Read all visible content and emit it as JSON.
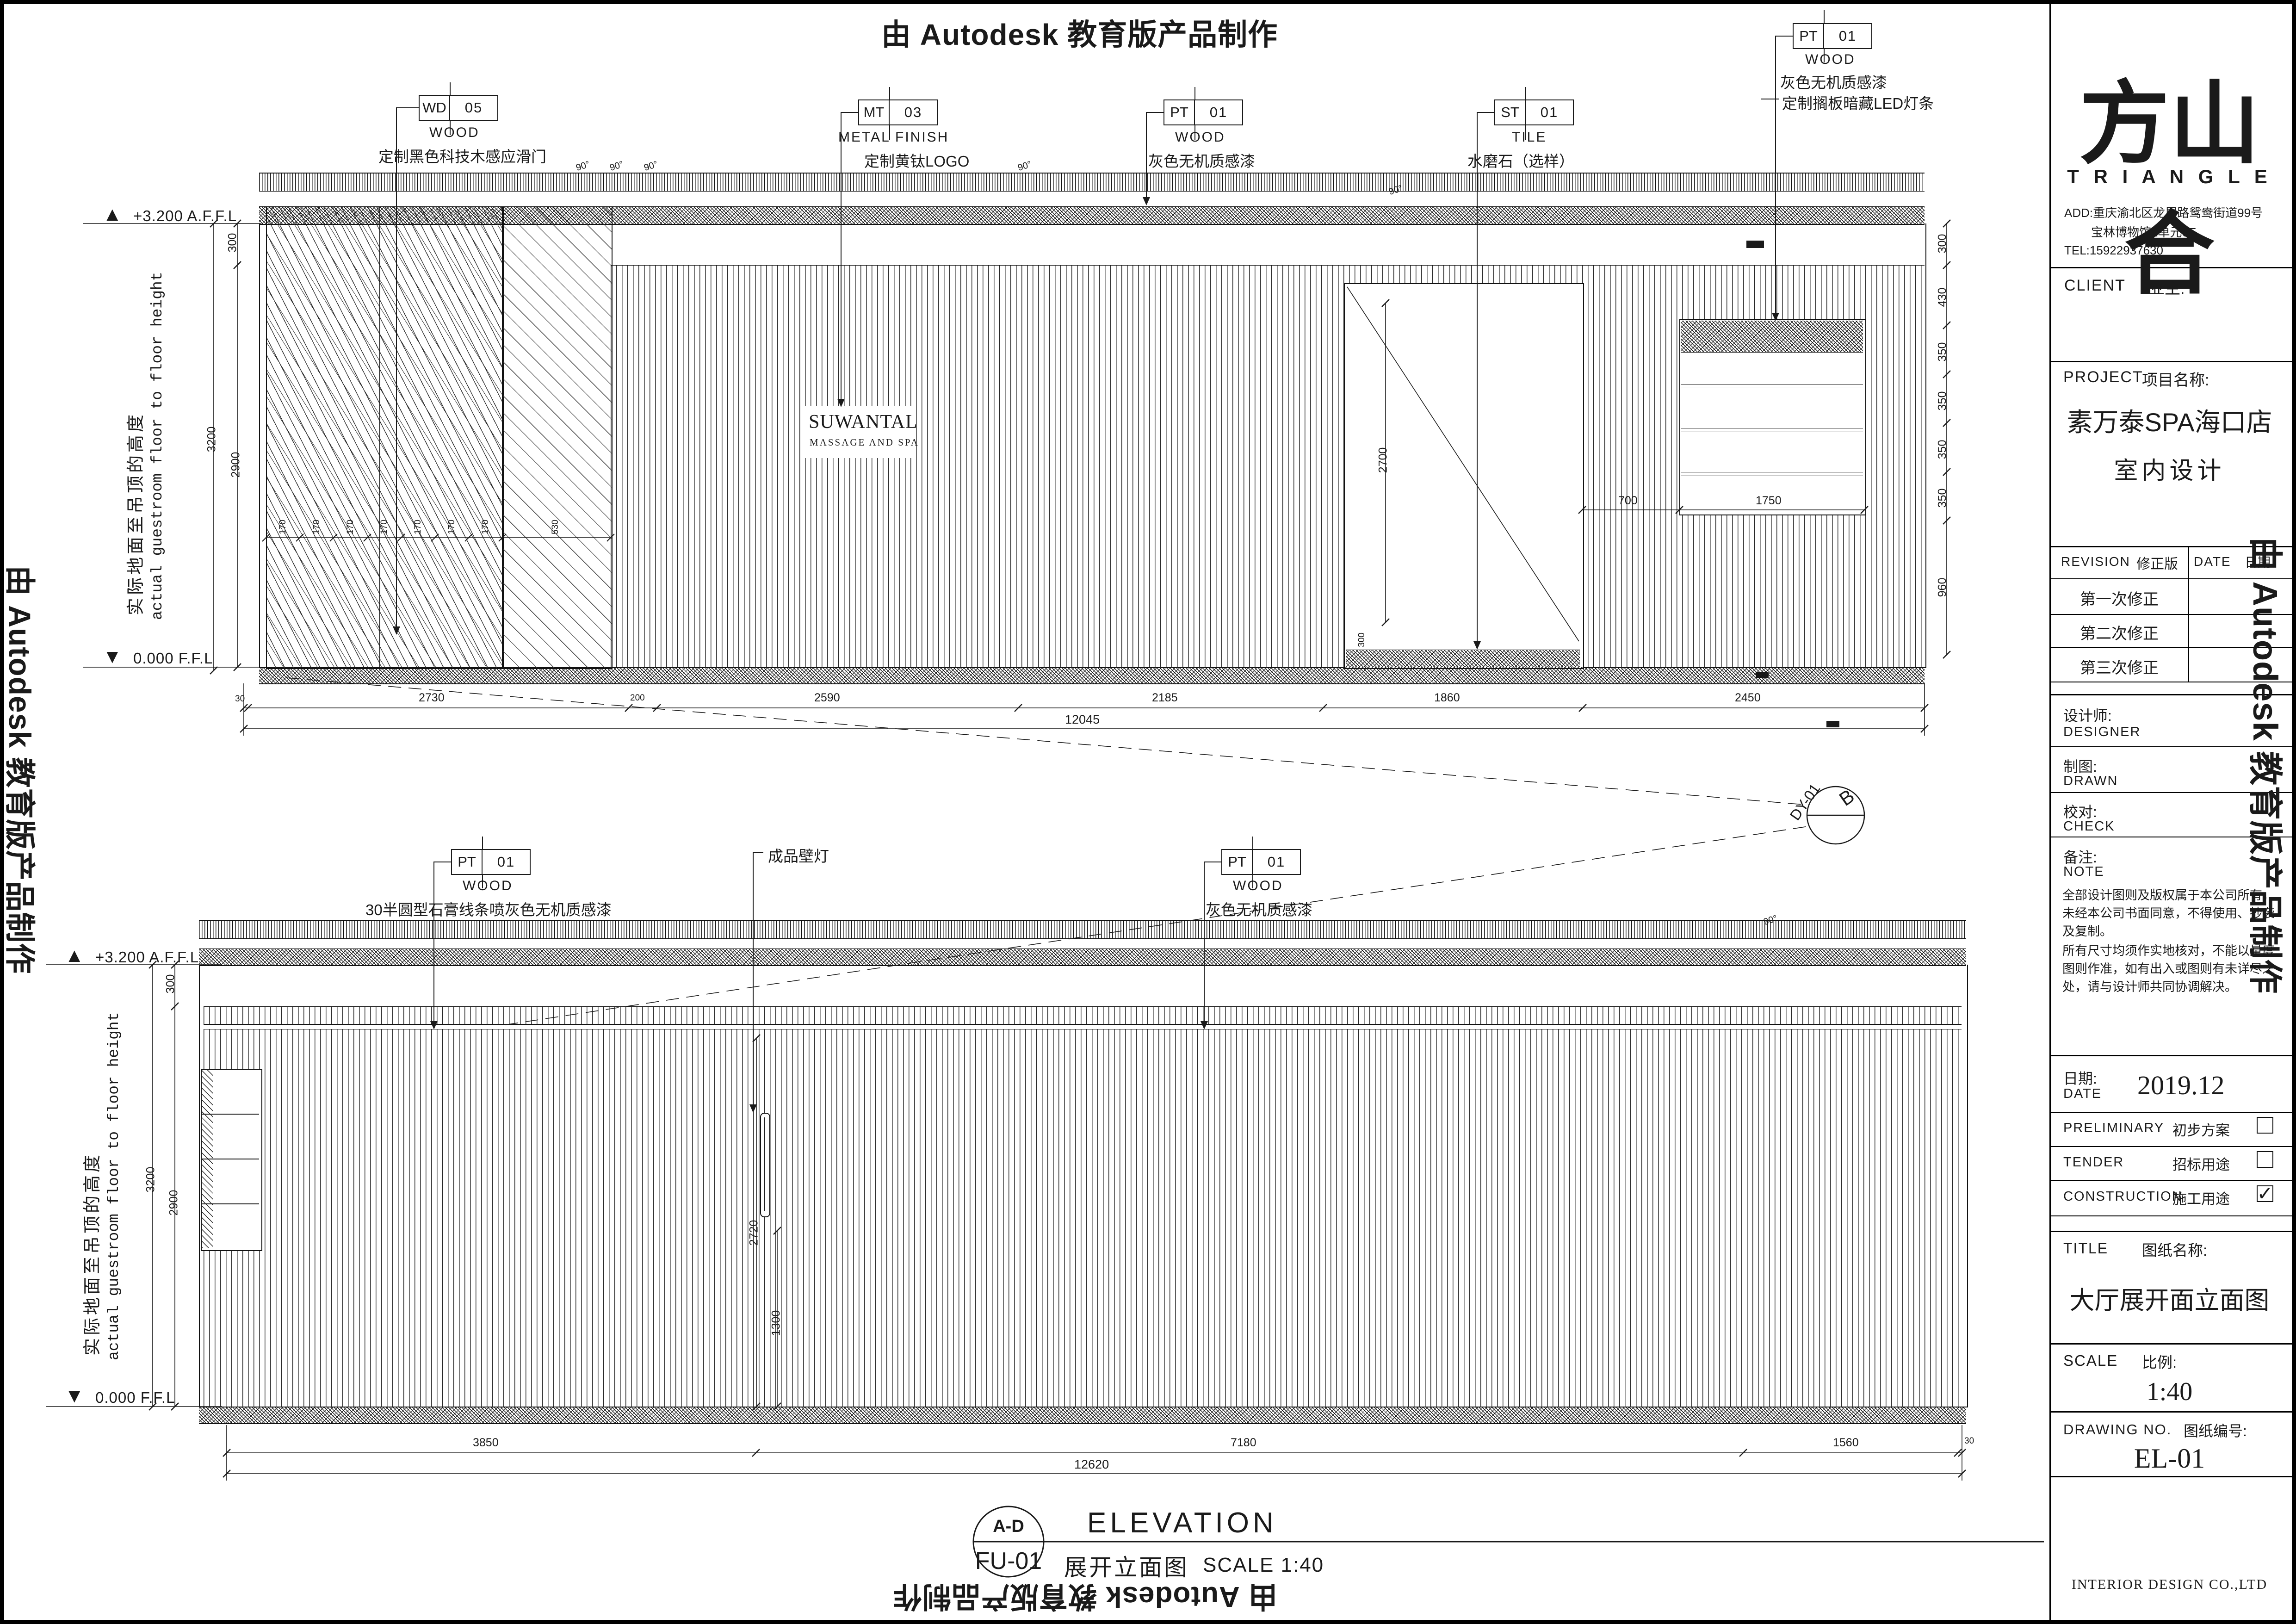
{
  "banner": {
    "text": "由 Autodesk 教育版产品制作"
  },
  "labels": {
    "angle": "90°",
    "level_top": "+3.200 A.F.F.L",
    "level_bottom": "0.000 F.F.L",
    "side_cn": "实际地面至吊顶的高度",
    "side_en": "actual guestroom floor to floor height",
    "wall_lamp": "成品壁灯"
  },
  "wall_logo": {
    "name": "SUWANTAL",
    "sub": "MASSAGE AND SPA"
  },
  "callouts": {
    "wd05": {
      "code": "WD",
      "num": "05",
      "material": "WOOD",
      "desc": "定制黑色科技木感应滑门"
    },
    "mt03": {
      "code": "MT",
      "num": "03",
      "material": "METAL FINISH",
      "desc": "定制黄钛LOGO"
    },
    "pt01_top": {
      "code": "PT",
      "num": "01",
      "material": "WOOD",
      "desc": "灰色无机质感漆"
    },
    "st01": {
      "code": "ST",
      "num": "01",
      "material": "TILE",
      "desc": "水磨石（选样）"
    },
    "pt01_shelf": {
      "code": "PT",
      "num": "01",
      "material": "WOOD",
      "desc": "灰色无机质感漆",
      "extra": "定制搁板暗藏LED灯条"
    },
    "pt01_crown": {
      "code": "PT",
      "num": "01",
      "material": "WOOD",
      "desc": "30半圆型石膏线条喷灰色无机质感漆"
    },
    "pt01_wall": {
      "code": "PT",
      "num": "01",
      "material": "WOOD",
      "desc": "灰色无机质感漆"
    }
  },
  "top_view": {
    "dims": [
      "30",
      "2730",
      "200",
      "2590",
      "2185",
      "1860",
      "2450"
    ],
    "total": "12045",
    "left_dims": [
      "300",
      "3200",
      "2900"
    ],
    "right_dims": [
      "300",
      "430",
      "350",
      "350",
      "350",
      "350",
      "960"
    ],
    "door_dims": [
      "170",
      "170",
      "170",
      "170",
      "170",
      "170",
      "170",
      "530"
    ],
    "inner": {
      "opening_h": "2700",
      "tile_h": "300",
      "shelf_gap": "700",
      "shelf_w": "1750"
    }
  },
  "bottom_view": {
    "dims": [
      "3850",
      "7180",
      "1560",
      "30"
    ],
    "total": "12620",
    "left_dims": [
      "300",
      "3200",
      "2900"
    ],
    "lamp_dims": [
      "2720",
      "1300"
    ]
  },
  "view_title": {
    "marker_top": "A-D",
    "marker_code": "FU-01",
    "title_en": "ELEVATION",
    "title_cn": "展开立面图",
    "scale": "SCALE   1:40"
  },
  "section_marker": {
    "code": "DY-01",
    "letter": "B"
  },
  "titleblock": {
    "logo_cn": "方山合",
    "logo_en": "T R I A N G L E",
    "add1": "ADD:重庆渝北区龙展路鸳鸯街道99号",
    "add2": "宝林博物馆2单元6F",
    "tel": "TEL:15922937630",
    "client_en": "CLIENT",
    "client_cn": "业主:",
    "project_en": "PROJECT",
    "project_cn": "项目名称:",
    "project_name1": "素万泰SPA海口店",
    "project_name2": "室内设计",
    "revision_en": "REVISION",
    "revision_cn": "修正版",
    "date_col_en": "DATE",
    "date_col_cn": "日期",
    "rev1": "第一次修正",
    "rev2": "第二次修正",
    "rev3": "第三次修正",
    "designer_cn": "设计师:",
    "designer_en": "DESIGNER",
    "drawn_cn": "制图:",
    "drawn_en": "DRAWN",
    "check_cn": "校对:",
    "check_en": "CHECK",
    "note_cn": "备注:",
    "note_en": "NOTE",
    "note1": "全部设计图则及版权属于本公司所有，未经本公司书面同意，不得使用、抄袭及复制。",
    "note2": "所有尺寸均须作实地核对，不能以量度图则作准，如有出入或图则有未详尽之处，请与设计师共同协调解决。",
    "date_cn": "日期:",
    "date_en": "DATE",
    "date_value": "2019.12",
    "prelim_en": "PRELIMINARY",
    "prelim_cn": "初步方案",
    "tender_en": "TENDER",
    "tender_cn": "招标用途",
    "constr_en": "CONSTRUCTION",
    "constr_cn": "施工用途",
    "constr_mark": "✓",
    "title_en": "TITLE",
    "title_cn": "图纸名称:",
    "drawing_title": "大厅展开面立面图",
    "scale_en": "SCALE",
    "scale_cn": "比例:",
    "scale_value": "1:40",
    "dwg_en": "DRAWING NO.",
    "dwg_cn": "图纸编号:",
    "dwg_value": "EL-01",
    "company": "INTERIOR DESIGN CO.,LTD"
  }
}
